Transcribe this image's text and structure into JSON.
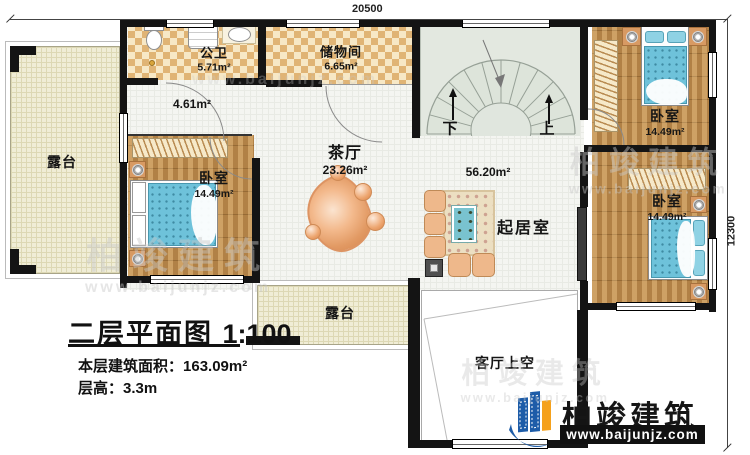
{
  "dimensions": {
    "top": "20500",
    "right": "12300"
  },
  "rooms": {
    "terrace_left": {
      "label": "露台"
    },
    "bathroom": {
      "label": "公卫",
      "area": "5.71m²"
    },
    "storage": {
      "label": "储物间",
      "area": "6.65m²"
    },
    "hallway": {
      "area": "4.61m²"
    },
    "tea_hall": {
      "label": "茶厅",
      "area": "23.26m²"
    },
    "bedroom_left": {
      "label": "卧室",
      "area": "14.49m²"
    },
    "bedroom_top_right": {
      "label": "卧室",
      "area": "14.49m²"
    },
    "bedroom_mid_right": {
      "label": "卧室",
      "area": "14.49m²"
    },
    "living_room": {
      "label": "起居室",
      "combined_area": "56.20m²"
    },
    "terrace_bottom": {
      "label": "露台"
    },
    "void_above_living": {
      "label": "客厅上空"
    }
  },
  "stairs": {
    "down_label": "下",
    "up_label": "上"
  },
  "title_block": {
    "title": "二层平面图",
    "scale": "1:100",
    "area_label": "本层建筑面积：",
    "area_value": "163.09m²",
    "height_label": "层高：",
    "height_value": "3.3m"
  },
  "brand": {
    "name": "柏竣建筑",
    "url": "www.baijunjz.com"
  },
  "colors": {
    "wall": "#141414",
    "wood": "#bd8c4e",
    "bed_blue": "#6ec2da",
    "brand_blue": "#1d5ca8",
    "brand_orange": "#f5a11c"
  }
}
